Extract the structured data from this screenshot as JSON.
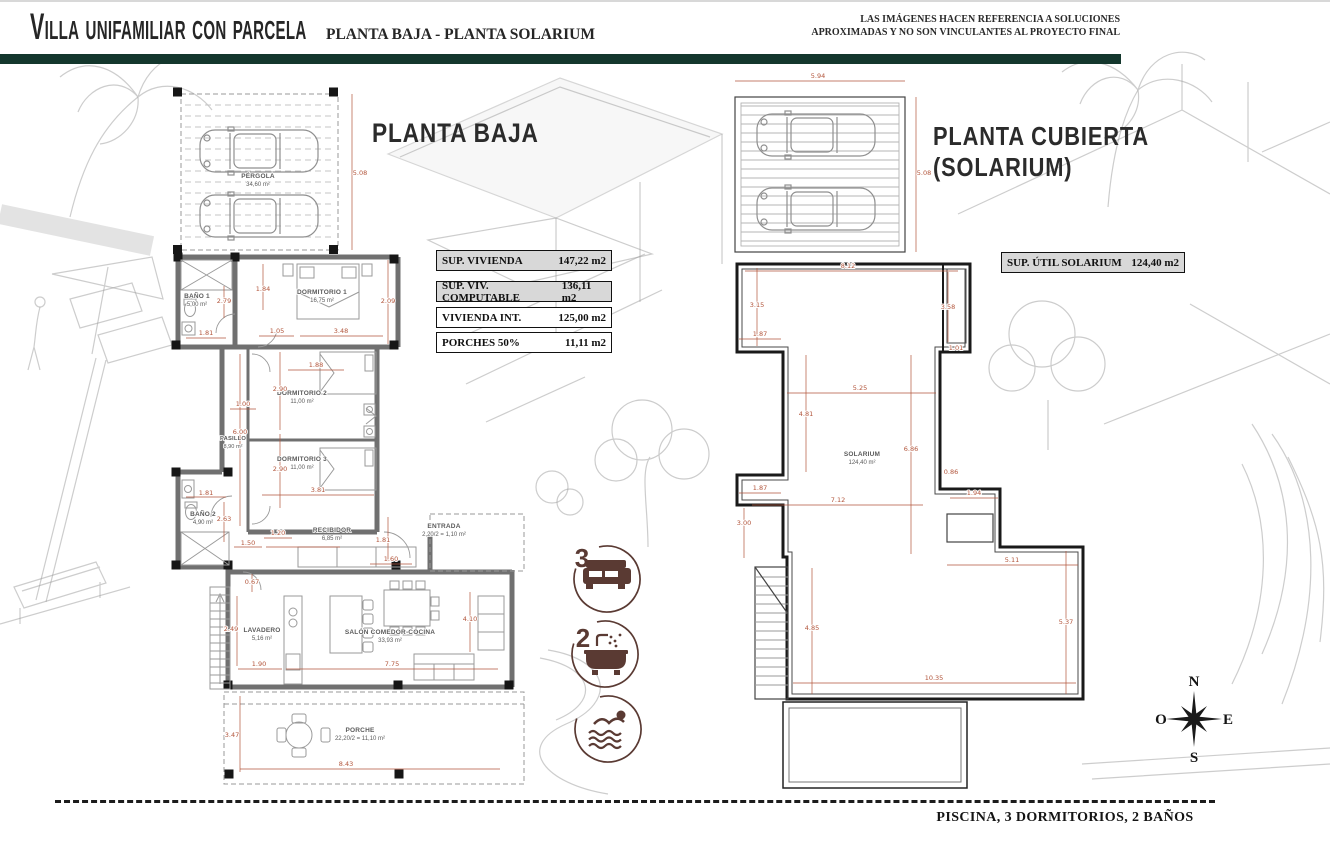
{
  "header": {
    "title": "Villa unifamiliar con parcela",
    "subtitle": "PLANTA BAJA - PLANTA SOLARIUM",
    "disclaimer_line1": "LAS IMÁGENES HACEN REFERENCIA A SOLUCIONES",
    "disclaimer_line2": "APROXIMADAS Y NO SON VINCULANTES AL PROYECTO FINAL"
  },
  "colors": {
    "accent_green": "#14372d",
    "dimension": "#b2553b",
    "icon_brown": "#5a3a33",
    "table_shaded": "#d8d8d8",
    "wall_gray": "#707070"
  },
  "planta_baja": {
    "title": "PLANTA BAJA",
    "area_table": [
      {
        "label": "SUP. VIVIENDA",
        "value": "147,22 m2"
      },
      {
        "label": "SUP. VIV. COMPUTABLE",
        "value": "136,11 m2"
      },
      {
        "label": "VIVIENDA INT.",
        "value": "125,00 m2"
      },
      {
        "label": "PORCHES 50%",
        "value": "11,11 m2"
      }
    ],
    "rooms": {
      "pergola": {
        "name": "PÉRGOLA",
        "area": "34,60 m²"
      },
      "bano1": {
        "name": "BAÑO 1",
        "area": "5,00 m²"
      },
      "dormitorio1": {
        "name": "DORMITORIO 1",
        "area": "16,75 m²"
      },
      "pasillo": {
        "name": "PASILLO",
        "area": "8,90 m²"
      },
      "dormitorio2": {
        "name": "DORMITORIO 2",
        "area": "11,00 m²"
      },
      "dormitorio3": {
        "name": "DORMITORIO 3",
        "area": "11,00 m²"
      },
      "bano2": {
        "name": "BAÑO 2",
        "area": "4,90 m²"
      },
      "recibidor": {
        "name": "RECIBIDOR",
        "area": "6,85 m²"
      },
      "entrada": {
        "name": "ENTRADA",
        "area": "2,20/2 = 1,10 m²"
      },
      "lavadero": {
        "name": "LAVADERO",
        "area": "5,16 m²"
      },
      "salon": {
        "name": "SALÓN COMEDOR-COCINA",
        "area": "33,93 m²"
      },
      "porche": {
        "name": "PORCHE",
        "area": "22,20/2 = 11,10 m²"
      }
    },
    "dims": {
      "pergola_h": "5.08",
      "bano1_w": "2.79",
      "dorm1_l": "1.84",
      "dorm1_r": "2.09",
      "dorm1_a": "1.05",
      "dorm1_b": "3.48",
      "bano1_d": "1.81",
      "mid_top": "1.88",
      "dorm2_h": "2.90",
      "pasillo_w": "1.00",
      "pasillo_h": "6.00",
      "dorm3_h": "2.90",
      "dorm3_w": "3.81",
      "bano2_w": "1.81",
      "bano2_h": "2.63",
      "recibidor_a": "1.20",
      "recibidor_w": "2.97",
      "recibidor_l": "1.50",
      "entrada_d": "1.81",
      "entrada_r": "1.60",
      "recibidor_d": "0.67",
      "lavadero_h": "2.49",
      "lavadero_w": "1.90",
      "salon_w": "7.75",
      "salon_h": "4.10",
      "porche_h": "3.47",
      "porche_w": "8.43"
    }
  },
  "solarium": {
    "title_line1": "PLANTA CUBIERTA",
    "title_line2": "(SOLARIUM)",
    "box": {
      "label": "SUP. ÚTIL SOLARIUM",
      "value": "124,40 m2"
    },
    "room": {
      "name": "SOLARIUM",
      "area": "124,40 m²"
    },
    "dims": {
      "pergola_w": "5.94",
      "pergola_h": "5.08",
      "top_w": "8.12",
      "top_l": "3.15",
      "top_r": "3.58",
      "step_l": "1.87",
      "step_r": "1.01",
      "mid_w": "5.25",
      "mid_l": "4.81",
      "mid_r": "6.86",
      "edge_r": "0.86",
      "notch": "1.87",
      "low_w": "7.12",
      "stair_w": "1.94",
      "left_h": "3.00",
      "bottom_l": "4.85",
      "right_w": "5.11",
      "right_h": "5.37",
      "bottom_w": "10.35"
    }
  },
  "features": {
    "bedrooms": "3",
    "bathrooms": "2"
  },
  "compass": {
    "north": "N",
    "east": "E",
    "south": "S",
    "west": "O"
  },
  "footer": {
    "summary": "PISCINA, 3 DORMITORIOS, 2 BAÑOS"
  }
}
